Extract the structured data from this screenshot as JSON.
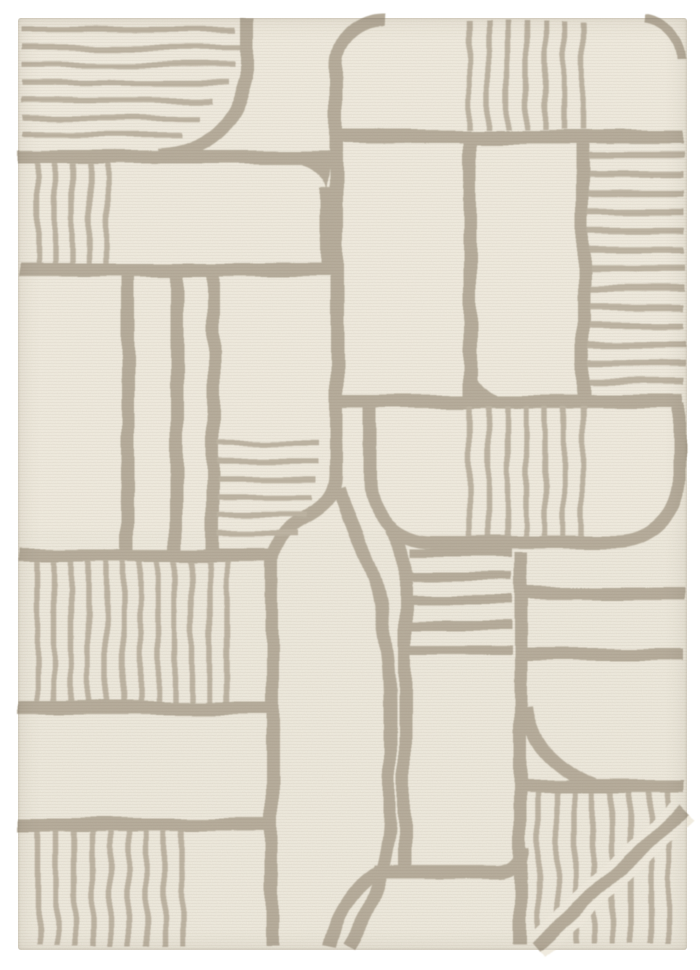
{
  "meta": {
    "title": "Cream and taupe geometric hand-tufted area rug",
    "view": "top-down product photo on white background"
  },
  "canvas": {
    "width": 700,
    "height": 970
  },
  "palette": {
    "page_bg": "#ffffff",
    "rug_bg": "#f0ebdf",
    "rug_bg_deep": "#ece6d9",
    "line_thick": "#b4aa99",
    "line_thin": "#bcb2a1",
    "grain_tint": "#8a7f6a"
  },
  "rug": {
    "frame": {
      "x": 18,
      "y": 18,
      "width": 669,
      "height": 932,
      "radius": 3
    },
    "stroke_widths": {
      "thick": 13,
      "wide": 9,
      "medium": 6.5,
      "thin": 5.5,
      "erase": 28
    },
    "shapes": [
      {
        "name": "stripes-top-left",
        "kind": "stroke",
        "weight": "thin",
        "d": "M22,30 H235 M22,48 H242 M22,65 H235 M22,83 H230 M22,100 H212 M22,118 H199 M22,135 H181"
      },
      {
        "name": "curve-top-left",
        "kind": "stroke",
        "weight": "thick",
        "d": "M247,18 V78 Q230,150 158,155"
      },
      {
        "name": "line-h1-left",
        "kind": "stroke",
        "weight": "thick",
        "d": "M18,157 H338"
      },
      {
        "name": "line-v1-s-curve",
        "kind": "stroke",
        "weight": "thick",
        "d": "M385,18 A47,47 0 0 0 336,65 L336,474 C336,524 272,510 272,564 L272,946"
      },
      {
        "name": "comb-left-small",
        "kind": "stroke",
        "weight": "thin",
        "d": "M38,163 V264 M55,163 V264 M72,163 V264 M89,163 V264 M106,163 V264"
      },
      {
        "name": "line-rect-right-edge",
        "kind": "stroke",
        "weight": "thick",
        "d": "M326,188 V270"
      },
      {
        "name": "fill-rect-corner",
        "kind": "fill",
        "d": "M296,163 A30,30 0 0 1 326,193 L330,163 Z"
      },
      {
        "name": "line-h4",
        "kind": "stroke",
        "weight": "thick",
        "d": "M18,270 H341"
      },
      {
        "name": "lines-columns",
        "kind": "stroke",
        "weight": "thick",
        "d": "M128,270 V554 M176,270 V554 M213,270 V554"
      },
      {
        "name": "stripes-mid-left",
        "kind": "stroke",
        "weight": "thin",
        "d": "M218,443 H318 M218,461 H318 M218,479 H316 M218,497 H312 M218,515 H306 M218,533 H298"
      },
      {
        "name": "line-h5-left",
        "kind": "stroke",
        "weight": "thick",
        "d": "M18,555 H269"
      },
      {
        "name": "comb-mid-left",
        "kind": "stroke",
        "weight": "thin",
        "d": "M37,561 V703 M54,561 V703 M71,561 V703 M88,561 V703 M106,561 V703 M123,561 V703 M140,561 V703 M158,561 V703 M175,561 V703 M192,561 V703 M210,561 V703 M227,561 V703"
      },
      {
        "name": "line-h6",
        "kind": "stroke",
        "weight": "thick",
        "d": "M18,708 H272"
      },
      {
        "name": "line-h7",
        "kind": "stroke",
        "weight": "thick",
        "d": "M18,824 H272"
      },
      {
        "name": "comb-bottom-left",
        "kind": "stroke",
        "weight": "thin",
        "d": "M38,830 V946 M56,830 V946 M74,830 V946 M92,830 V946 M110,830 V946 M128,830 V946 M146,830 V946 M164,830 V946 M182,830 V946"
      },
      {
        "name": "comb-top-center",
        "kind": "stroke",
        "weight": "thin",
        "d": "M469,20 V130 M488,20 V130 M507,20 V130 M526,20 V130 M545,20 V130 M564,20 V130 M583,20 V130"
      },
      {
        "name": "line-h2",
        "kind": "stroke",
        "weight": "thick",
        "d": "M330,137 H684"
      },
      {
        "name": "arc-top-right-corner",
        "kind": "stroke",
        "weight": "wide",
        "d": "M644,19 A42,42 0 0 1 681,60"
      },
      {
        "name": "line-v2",
        "kind": "stroke",
        "weight": "thick",
        "d": "M470,137 V400"
      },
      {
        "name": "line-v3",
        "kind": "stroke",
        "weight": "thick",
        "d": "M583,137 V400"
      },
      {
        "name": "stripes-top-right",
        "kind": "stroke",
        "weight": "medium",
        "d": "M589,155 H684 M589,174 H684 M589,193 H684 M589,212 H684 M589,231 H684 M589,250 H684 M589,269 H684 M589,288 H684 M589,307 H684 M589,326 H684 M589,345 H684 M589,364 H684 M589,382 H684"
      },
      {
        "name": "line-h3",
        "kind": "stroke",
        "weight": "thick",
        "d": "M341,402 H684"
      },
      {
        "name": "fill-fillet-v2-h3",
        "kind": "fill",
        "d": "M463,338 L463,404 L527,404 A64,64 0 0 1 463,338 Z"
      },
      {
        "name": "stadium-center",
        "kind": "stroke",
        "weight": "thick",
        "d": "M370,404 V480 A62,62 0 0 0 432,542 H617 A62,62 0 0 0 679,480 V404"
      },
      {
        "name": "comb-stadium",
        "kind": "stroke",
        "weight": "thin",
        "d": "M469,406 V536 M488,406 V536 M507,406 V536 M526,406 V536 M545,406 V536 M564,406 V536 M583,406 V536"
      },
      {
        "name": "stripes-block-center",
        "kind": "stroke",
        "weight": "wide",
        "d": "M411,553 H511 M411,577 H511 M411,601 H511 M411,625 H511 M411,649 H511"
      },
      {
        "name": "curve-paren",
        "kind": "stroke",
        "weight": "thick",
        "d": "M339,488 C354,538 372,558 379,600 C386,642 390,662 390,704 L390,812 C390,868 370,912 349,946"
      },
      {
        "name": "ring-left",
        "kind": "stroke",
        "weight": "thick",
        "d": "M391,528 C402,543 405,558 405,580 V872"
      },
      {
        "name": "ring-bottom",
        "kind": "stroke",
        "weight": "thick",
        "d": "M374,872 H499 A25,25 0 0 0 523,848"
      },
      {
        "name": "curve-ring-tail",
        "kind": "stroke",
        "weight": "thick",
        "d": "M382,870 Q342,892 330,946"
      },
      {
        "name": "comb-bottom-right",
        "kind": "stroke",
        "weight": "thin",
        "d": "M538,793 V944 M557,793 V944 M575,793 V944 M593,793 V944 M612,793 V944 M630,793 V944 M650,793 V944 M668,793 V944"
      },
      {
        "name": "erase-under-arc",
        "kind": "erase",
        "d": "M536,947 Q610,880 684,810"
      },
      {
        "name": "arc-bottom-right",
        "kind": "stroke",
        "weight": "thick",
        "d": "M536,947 Q610,880 684,810"
      },
      {
        "name": "line-h8",
        "kind": "stroke",
        "weight": "thick",
        "d": "M518,787 H684"
      },
      {
        "name": "arc-fillet-right",
        "kind": "stroke",
        "weight": "thick",
        "d": "M526,706 Q532,762 596,786"
      },
      {
        "name": "line-v8",
        "kind": "stroke",
        "weight": "thick",
        "d": "M520,552 V944"
      },
      {
        "name": "line-h5-right",
        "kind": "stroke",
        "weight": "thick",
        "d": "M520,594 H684"
      },
      {
        "name": "line-right-band",
        "kind": "stroke",
        "weight": "thick",
        "d": "M520,654 H684"
      }
    ]
  }
}
